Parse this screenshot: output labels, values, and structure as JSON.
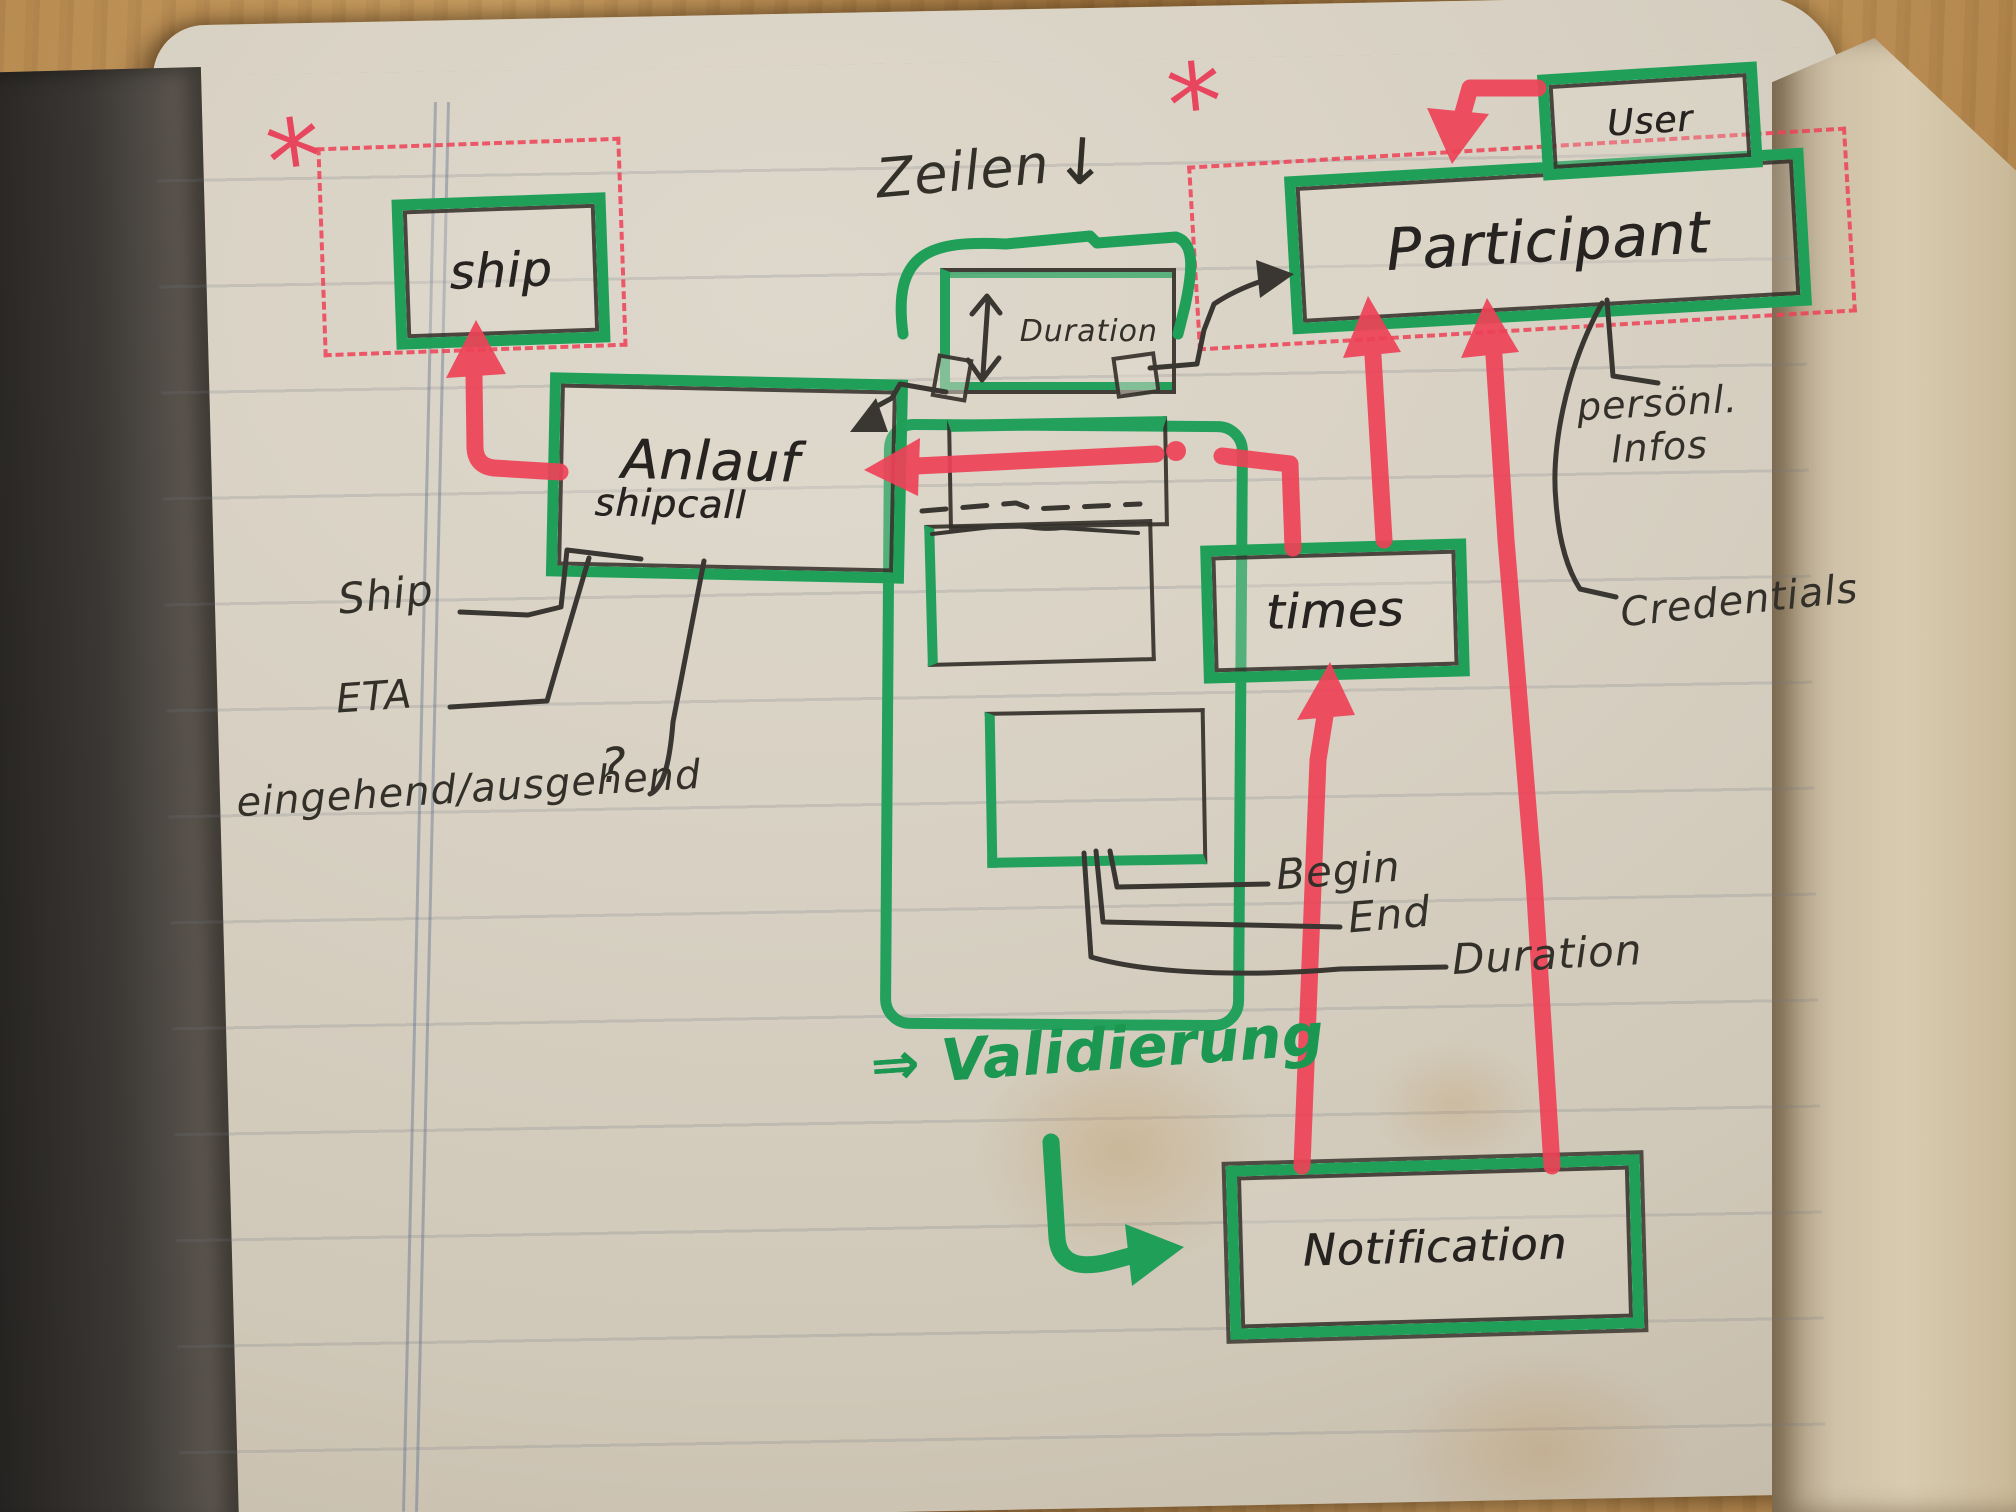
{
  "colors": {
    "marker_green": "#1f9f58",
    "marker_red": "#ee4257",
    "ink_black": "#33302a",
    "paper": "#d7d0c2"
  },
  "boxes": {
    "ship": {
      "label": "ship"
    },
    "anlauf": {
      "label": "Anlauf",
      "sublabel": "shipcall"
    },
    "duration": {
      "label": "Duration"
    },
    "participant": {
      "label": "Participant"
    },
    "user": {
      "label": "User"
    },
    "times": {
      "label": "times"
    },
    "notification": {
      "label": "Notification"
    }
  },
  "annotations": {
    "zeilen": "Zeilen",
    "ship_attr": "Ship",
    "eta": "ETA",
    "in_out": "eingehend/ausgehend",
    "question_mark": "?",
    "begin": "Begin",
    "end": "End",
    "duration_attr": "Duration",
    "personal_infos": "persönl.\nInfos",
    "credentials": "Credentials",
    "validierung": "⇒ Validierung"
  },
  "icons": {
    "asterisk": "*",
    "down_arrow": "↓"
  }
}
